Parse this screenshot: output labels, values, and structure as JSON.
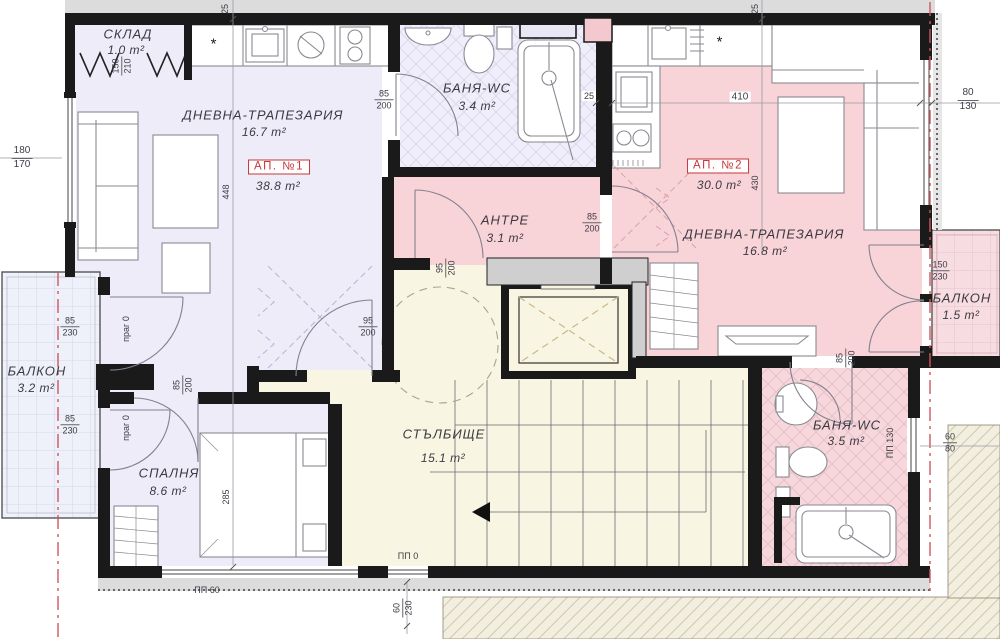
{
  "colors": {
    "ap1_fill": "#edecf8",
    "ap2_fill": "#f8d3d8",
    "stair_fill": "#f8f5e3",
    "balcony_left_fill": "#eef1f9",
    "balcony_right_fill": "#f7dde2",
    "wall": "#1a1a1a",
    "accent_red": "#c4393c",
    "neighbor_hatch": "#f2efe0"
  },
  "apartments": [
    {
      "badge": "АП. №1",
      "total_area": "38.8 m²"
    },
    {
      "badge": "АП. №2",
      "total_area": "30.0 m²"
    }
  ],
  "rooms": {
    "sklad": {
      "name": "СКЛАД",
      "area": "1.0 m²"
    },
    "living1": {
      "name": "ДНЕВНА-ТРАПЕЗАРИЯ",
      "area": "16.7 m²"
    },
    "bath1": {
      "name": "БАНЯ-WC",
      "area": "3.4 m²"
    },
    "antre": {
      "name": "АНТРЕ",
      "area": "3.1 m²"
    },
    "living2": {
      "name": "ДНЕВНА-ТРАПЕЗАРИЯ",
      "area": "16.8 m²"
    },
    "balcony_r": {
      "name": "БАЛКОН",
      "area": "1.5 m²"
    },
    "bath2": {
      "name": "БАНЯ-WC",
      "area": "3.5 m²"
    },
    "stair": {
      "name": "СТЪЛБИЩЕ",
      "area": "15.1 m²"
    },
    "bedroom": {
      "name": "СПАЛНЯ",
      "area": "8.6 m²"
    },
    "balcony_l": {
      "name": "БАЛКОН",
      "area": "3.2 m²"
    }
  },
  "dims": {
    "top_left_25": "25",
    "v448": "448",
    "v285": "285",
    "top_right_25": "25",
    "v430": "430",
    "h410": "410",
    "wall_25": "25",
    "prag_up": "праг 0",
    "prag_dn": "праг 0",
    "pp60": "ПП 60",
    "pp0": "ПП 0",
    "pp130": "ПП 130",
    "f_sklad": {
      "n": "150",
      "d": "210"
    },
    "f_bath1door": {
      "n": "85",
      "d": "200"
    },
    "f_lwin": {
      "n": "180",
      "d": "170"
    },
    "f_lbalc_up": {
      "n": "85",
      "d": "230"
    },
    "f_lbalc_dn": {
      "n": "85",
      "d": "230"
    },
    "f_beddoor": {
      "n": "85",
      "d": "200"
    },
    "f_ent1": {
      "n": "95",
      "d": "200"
    },
    "f_ent1b": {
      "n": "95",
      "d": "200"
    },
    "f_ent2": {
      "n": "85",
      "d": "200"
    },
    "f_bath2door": {
      "n": "85",
      "d": "200"
    },
    "f_rbalc": {
      "n": "150",
      "d": "230"
    },
    "f_rwin": {
      "n": "80",
      "d": "130"
    },
    "f_bath2win": {
      "n": "60",
      "d": "80"
    },
    "f_stairwin": {
      "n": "60",
      "d": "230"
    }
  },
  "symbols": {
    "star": "*"
  }
}
